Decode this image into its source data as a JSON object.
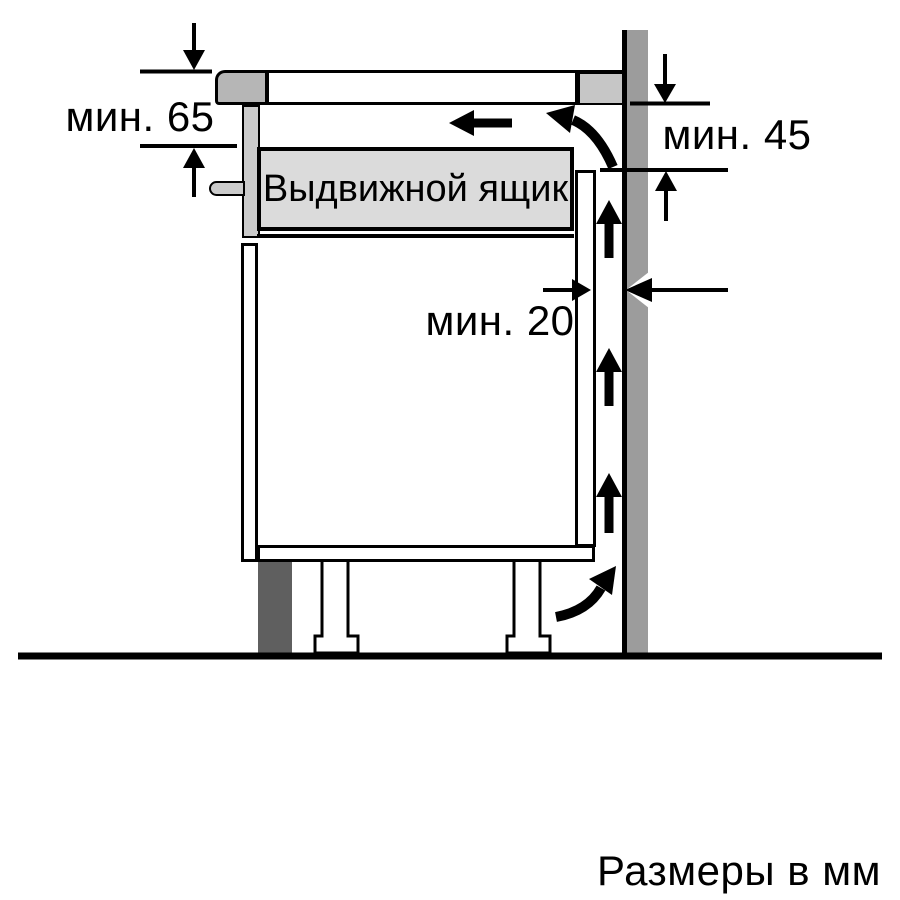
{
  "drawer": {
    "label": "Выдвижной ящик"
  },
  "dimensions": {
    "top_clearance": {
      "label": "мин. 65"
    },
    "vent_clearance": {
      "label": "мин. 45"
    },
    "rear_gap": {
      "label": "мин. 20"
    }
  },
  "footer": {
    "note": "Размеры в мм"
  },
  "airflow": {
    "up_arrow_count": 3
  },
  "icons": {
    "up-arrow": "▲",
    "left-arrow": "◀",
    "curved-arrow": "⤴",
    "dimension-arrow": "▼"
  },
  "colors": {
    "background": "#ffffff",
    "outline": "#000000",
    "wall": "#9c9c9c",
    "worktop_edge_block": "#c6c6c6",
    "hob_profile": "#b6b6b6",
    "panel_gray": "#cbcbcb",
    "drawer_fill": "#dbdbdb",
    "plinth": "#5f5f5f"
  }
}
